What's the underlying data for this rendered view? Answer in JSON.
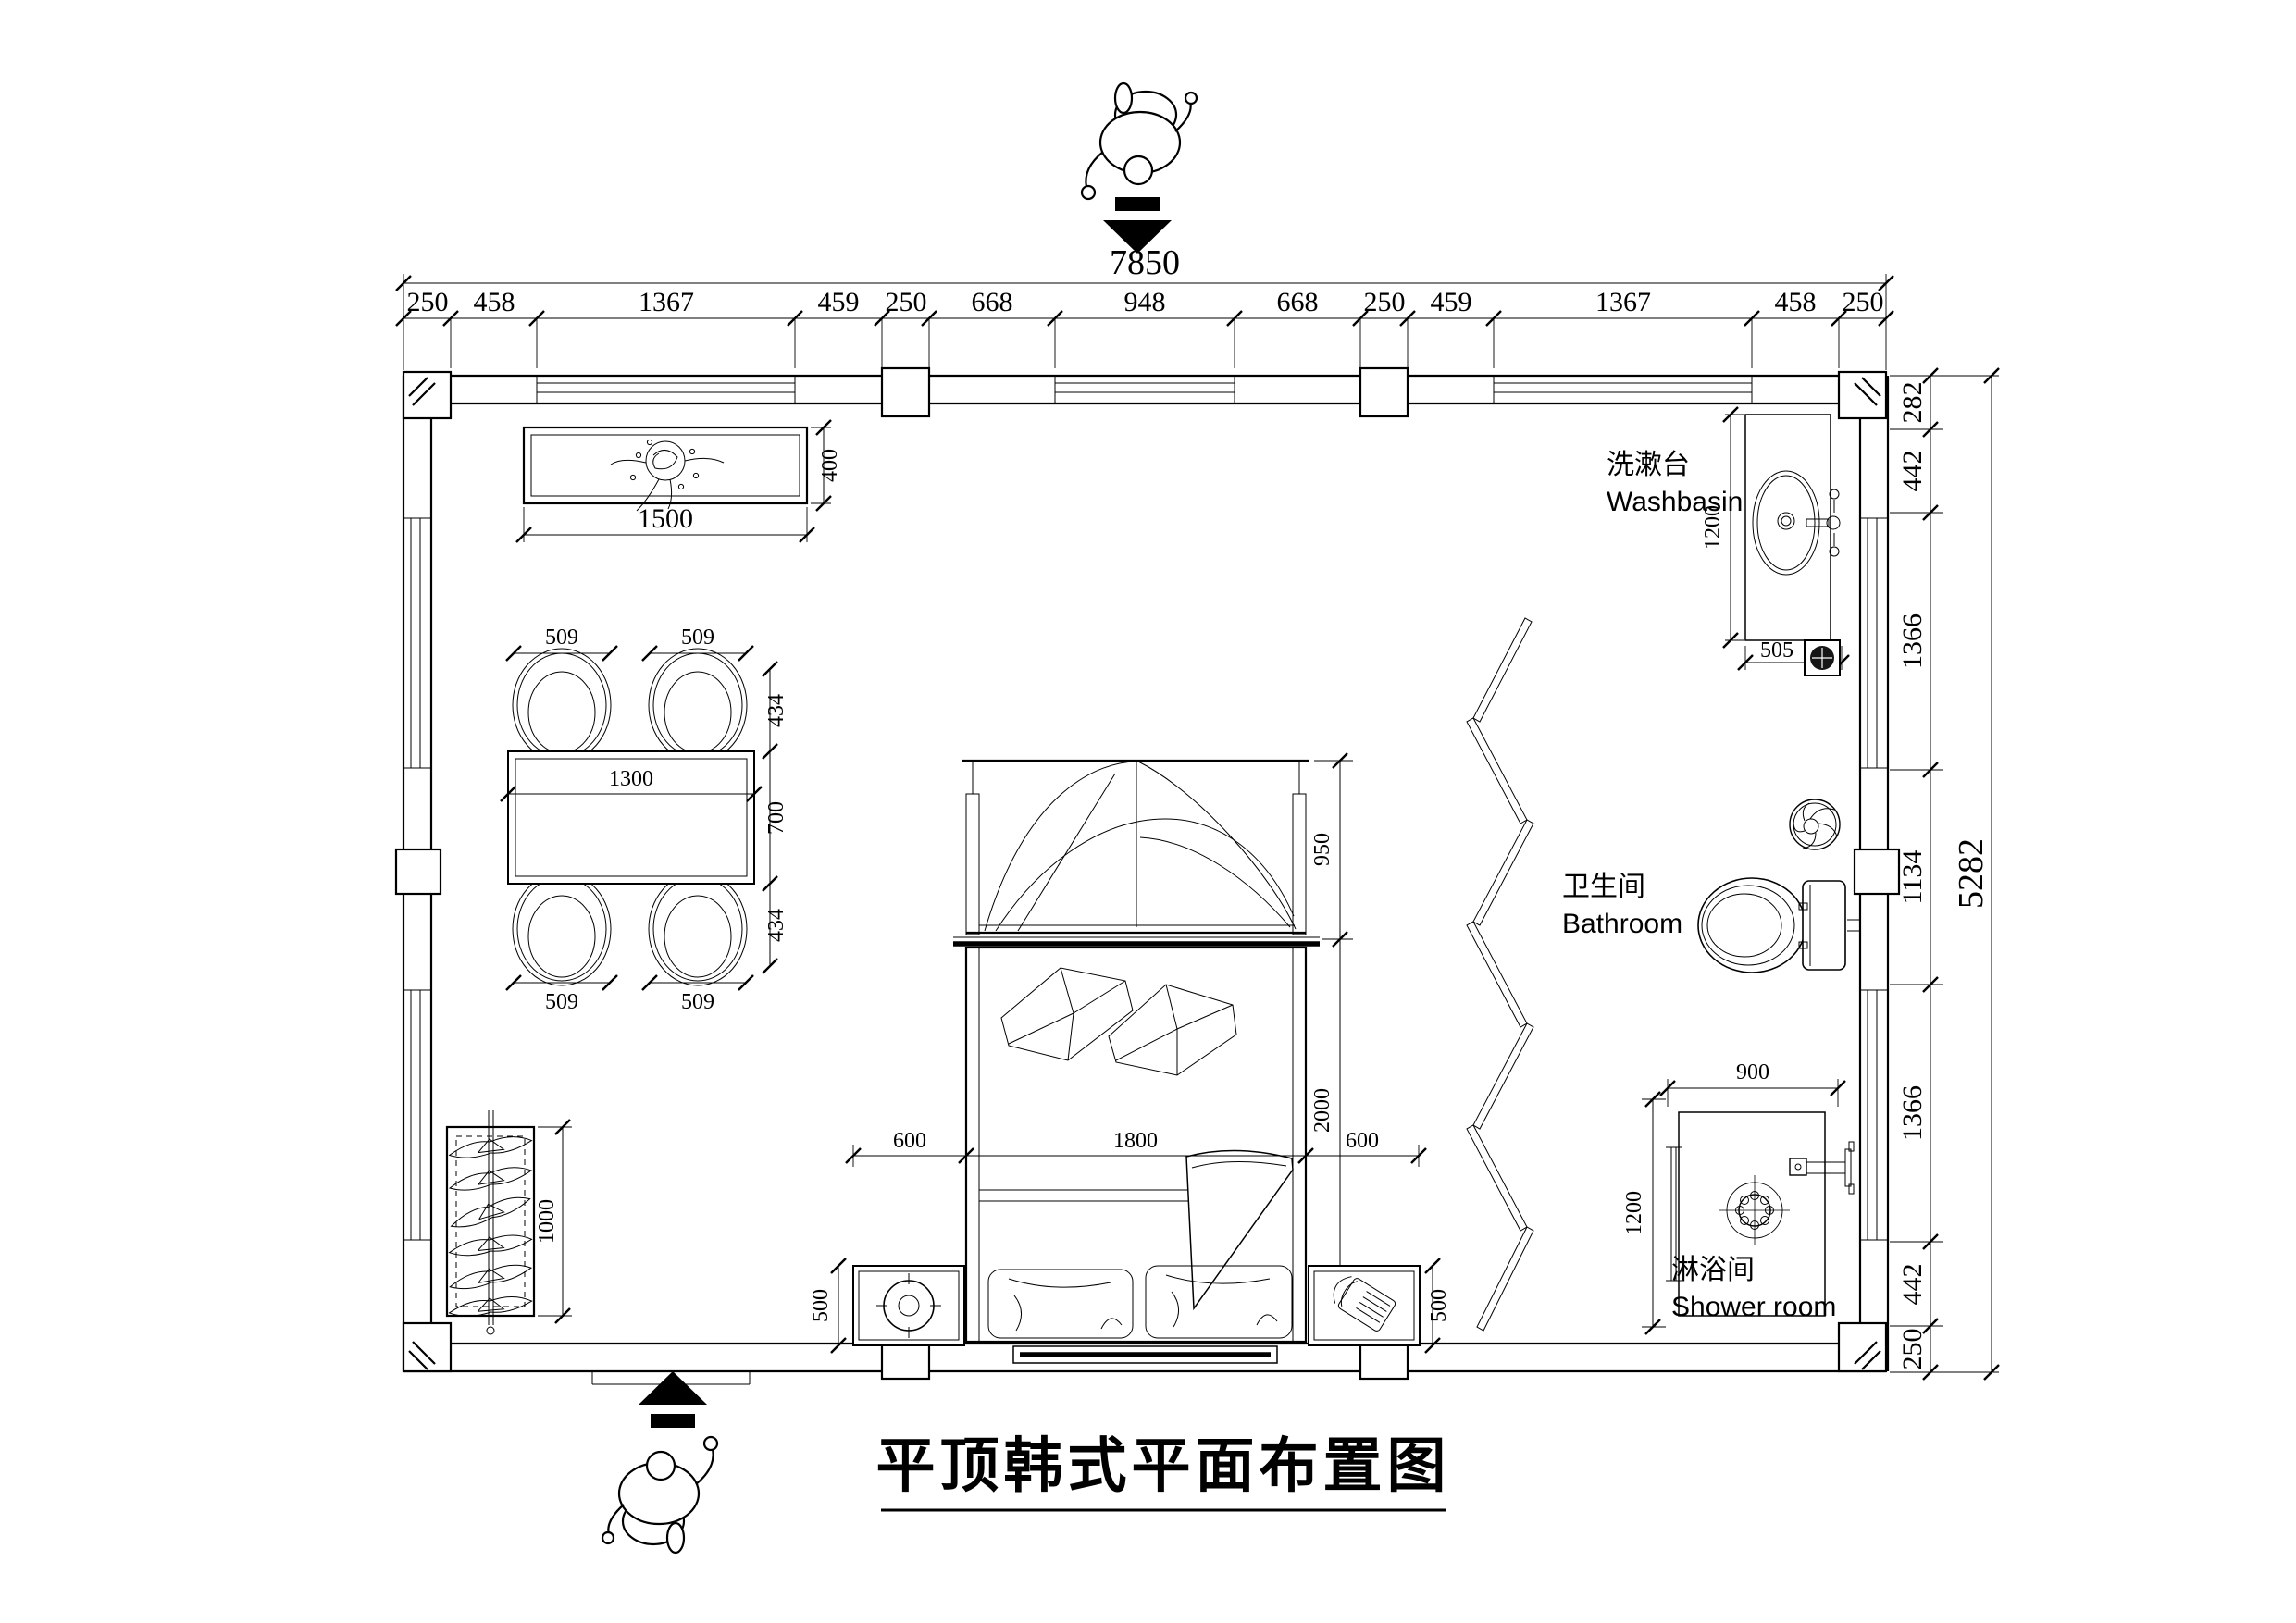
{
  "title": "平顶韩式平面布置图",
  "rooms": {
    "washbasin": {
      "zh": "洗漱台",
      "en": "Washbasin"
    },
    "bathroom": {
      "zh": "卫生间",
      "en": "Bathroom"
    },
    "shower": {
      "zh": "淋浴间",
      "en": "Shower room"
    }
  },
  "dims": {
    "top_total": "7850",
    "top": [
      "250",
      "458",
      "1367",
      "459",
      "250",
      "668",
      "948",
      "668",
      "250",
      "459",
      "1367",
      "458",
      "250"
    ],
    "right": [
      "282",
      "442",
      "1366",
      "1134",
      "1366",
      "442",
      "250"
    ],
    "right_total": "5282",
    "cabinet_w": "1500",
    "cabinet_d": "400",
    "chairs": [
      "509",
      "509",
      "509",
      "509"
    ],
    "dining_side": [
      "434",
      "700",
      "434"
    ],
    "table_w": "1300",
    "wardrobe_len": "1000",
    "canopy": "950",
    "bed_left": "600",
    "bed_width": "1800",
    "bed_length": "2000",
    "bed_right": "600",
    "nightstands": [
      "500",
      "500"
    ],
    "basin_depth": "1200",
    "basin_width": "505",
    "shower_w": "900",
    "shower_d": "1200"
  }
}
